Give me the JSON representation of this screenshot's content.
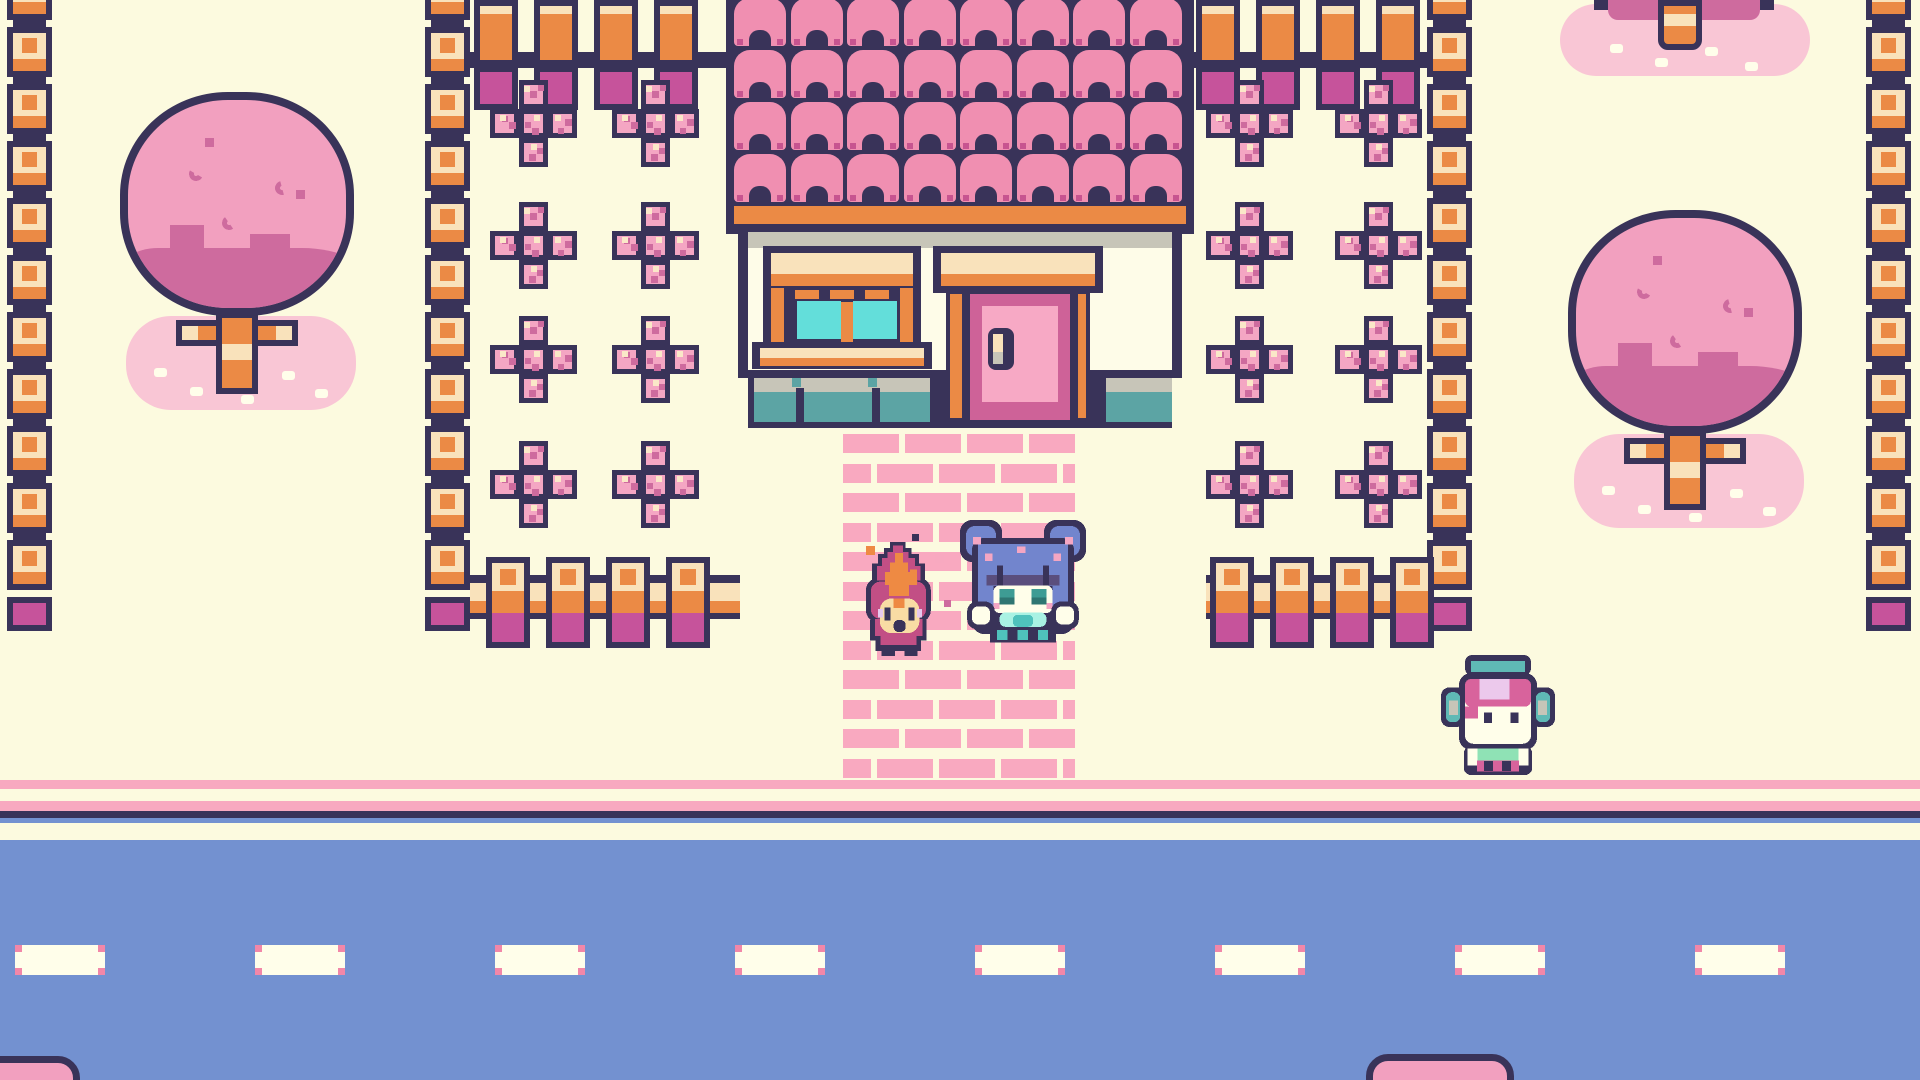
{
  "scene": {
    "width": 1920,
    "height": 1080,
    "label": "pastel-town-overworld"
  },
  "palette": {
    "cream": "#FCFADF",
    "navy": "#393359",
    "orange": "#EB8A45",
    "postCream": "#F9E2BB",
    "magenta": "#C6539B",
    "tilePink": "#F08FB1",
    "tileNotch": "#C75490",
    "flowerPink": "#F4A6C3",
    "flowerDark": "#CE6B9E",
    "flowerLight": "#FAE8C8",
    "treePink": "#F2A0BF",
    "treeDark": "#CE6B9E",
    "poolPink": "#F9C6D5",
    "white": "#FFFEEA",
    "gray": "#C7C5B8",
    "tealBase": "#5CA4A4",
    "glass": "#63DEDA",
    "doorPink": "#F7A9C5",
    "doorDark": "#CE6298",
    "roadBlue": "#7391D0",
    "stripePink": "#F8A9C0",
    "dashCorner": "#F287A8",
    "brickPink": "#F9A9C0",
    "wallFace": "#FEFCE8",
    "girlHair": "#7285CD",
    "girlBangs": "#5A4E7D",
    "girlEye": "#3E9C94",
    "girlEyeDark": "#2F7672",
    "mint": "#A9F2E3",
    "scarfTeal": "#4FC2BC",
    "flameRose": "#C24F85",
    "flameOrange": "#EE8A43",
    "flameFace": "#F8DCA4",
    "lavender": "#E6C8EE",
    "kidHair": "#D8639C",
    "kidLavender": "#ECC9EC",
    "kidTeal": "#5FB9B5",
    "kidMint": "#8FE2B5"
  },
  "layout": {
    "road": {
      "stripes": [
        [
          780,
          9
        ],
        [
          801,
          10
        ]
      ],
      "navy_line": [
        811,
        7
      ],
      "blue_sliver": [
        818,
        5
      ],
      "cream_strip": [
        823,
        17
      ],
      "asphalt": [
        840,
        240
      ],
      "dashes": {
        "y": 945,
        "h": 30,
        "start_x": 15,
        "width": 90,
        "period": 240,
        "count": 8,
        "corner": 7
      }
    },
    "path": {
      "x": 843,
      "y": 434,
      "w": 232,
      "rows": 12,
      "row_period": 29.5,
      "row_h": 19,
      "brick_w": 56,
      "brick_gap": 6,
      "odd_offset": 34,
      "odd_first_w": 28
    },
    "fence_columns": [
      {
        "x": 7,
        "y": -30,
        "units": 11,
        "cap": true,
        "name": "fence-column-left-edge"
      },
      {
        "x": 425,
        "y": -30,
        "units": 11,
        "cap": true,
        "name": "fence-column-left-garden"
      },
      {
        "x": 1427,
        "y": -30,
        "units": 11,
        "cap": true,
        "name": "fence-column-right-garden"
      },
      {
        "x": 1866,
        "y": -30,
        "units": 11,
        "cap": true,
        "name": "fence-column-right-edge"
      }
    ],
    "fence_unit": {
      "w": 45,
      "block_h": 50,
      "period": 57,
      "cap_h": 34
    },
    "top_fence_rows": [
      {
        "x": 470,
        "w": 258,
        "posts": [
          4,
          64,
          124,
          184
        ],
        "name": "top-fence-row-left"
      },
      {
        "x": 1192,
        "w": 235,
        "posts": [
          4,
          64,
          124,
          184
        ],
        "name": "top-fence-row-right"
      }
    ],
    "garden_fence_rows": [
      {
        "x": 470,
        "w": 270,
        "posts": [
          16,
          76,
          136,
          196
        ],
        "name": "garden-fence-left"
      },
      {
        "x": 1206,
        "w": 221,
        "posts": [
          4,
          64,
          124,
          184
        ],
        "name": "garden-fence-right"
      }
    ],
    "garden_fence_y": 557,
    "flowers": {
      "size": 87,
      "cell": 29,
      "rows": [
        80,
        202,
        316,
        441
      ],
      "cols_left": [
        490,
        612
      ],
      "cols_right": [
        1206,
        1335
      ]
    },
    "house": {
      "roof": [
        726,
        0,
        468,
        234
      ],
      "roof_trim": [
        734,
        206,
        452,
        18
      ],
      "tiles": {
        "x": 734,
        "y": -2,
        "cols": 8,
        "rows": 4,
        "tw": 52,
        "th": 48,
        "sx": 56.5,
        "sy": 52
      },
      "wall": [
        738,
        226,
        444,
        152
      ],
      "wall_shadow": [
        748,
        232,
        424,
        16
      ],
      "wall_face": [
        748,
        248,
        424,
        122
      ],
      "base": {
        "navy": [
          748,
          370,
          424,
          58
        ],
        "sections": [
          [
            754,
            378,
            176
          ],
          [
            1106,
            378,
            66
          ]
        ],
        "separators": [
          [
            796,
            388,
            8,
            34
          ],
          [
            872,
            388,
            8,
            34
          ]
        ],
        "notches": [
          [
            792,
            378,
            9,
            9
          ],
          [
            868,
            378,
            9,
            9
          ]
        ]
      },
      "window": {
        "frame": [
          763,
          246,
          158,
          104
        ],
        "awning_top": [
          771,
          253,
          142,
          21
        ],
        "awning_trim": [
          771,
          274,
          142,
          12
        ],
        "side_l": [
          771,
          288,
          13,
          56
        ],
        "side_r": [
          900,
          288,
          13,
          56
        ],
        "dashes": [
          [
            795,
            290,
            24,
            9
          ],
          [
            830,
            290,
            24,
            9
          ],
          [
            865,
            290,
            24,
            9
          ]
        ],
        "panes": [
          [
            797,
            301,
            44,
            38
          ],
          [
            853,
            301,
            44,
            38
          ]
        ],
        "divider": [
          841,
          302,
          12,
          40
        ],
        "sill": [
          752,
          342,
          180,
          27
        ],
        "sill_top": [
          760,
          348,
          164,
          10
        ],
        "sill_trim": [
          760,
          358,
          164,
          8
        ]
      },
      "door": {
        "awning": [
          933,
          246,
          170,
          47
        ],
        "awning_top": [
          941,
          253,
          154,
          21
        ],
        "awning_trim": [
          941,
          274,
          154,
          12
        ],
        "post_l_outline": [
          946,
          290,
          22,
          132
        ],
        "post_l": [
          950,
          294,
          14,
          124
        ],
        "post_r_outline": [
          1068,
          290,
          22,
          132
        ],
        "post_r": [
          1072,
          294,
          14,
          124
        ],
        "panel_outline": [
          962,
          286,
          116,
          142
        ],
        "panel_frame": [
          970,
          294,
          100,
          126
        ],
        "panel": [
          982,
          306,
          76,
          96
        ],
        "handle_outline": [
          988,
          328,
          26,
          42
        ],
        "handle_top": [
          993,
          334,
          10,
          20
        ],
        "handle_base": [
          993,
          352,
          10,
          12
        ]
      }
    },
    "trees": [
      {
        "name": "blossom-tree-left",
        "canopy": [
          120,
          92,
          234,
          224
        ],
        "pool": [
          126,
          316,
          230,
          94
        ],
        "trunk": [
          216,
          312,
          42,
          82
        ],
        "branch": [
          176,
          320,
          122,
          26
        ]
      },
      {
        "name": "blossom-tree-right",
        "canopy": [
          1568,
          210,
          234,
          224
        ],
        "pool": [
          1574,
          434,
          230,
          94
        ],
        "trunk": [
          1664,
          430,
          42,
          80
        ],
        "branch": [
          1624,
          438,
          122,
          26
        ]
      }
    ],
    "partial_trees": {
      "top_right": {
        "pool": [
          1560,
          4,
          250,
          72
        ],
        "trunk": [
          1658,
          0,
          44,
          50
        ],
        "band": [
          1608,
          0,
          152,
          20
        ]
      },
      "bottom_tops": [
        {
          "name": "treetop-bottom-left",
          "x": -46,
          "y": 1056,
          "w": 126,
          "h": 60
        },
        {
          "name": "treetop-bottom-right",
          "x": 1366,
          "y": 1054,
          "w": 148,
          "h": 60
        }
      ]
    },
    "sparkles": [
      {
        "x": 866,
        "y": 546,
        "s": 9,
        "c": "flameOrange"
      },
      {
        "x": 935,
        "y": 554,
        "s": 9,
        "c": "stripePink"
      },
      {
        "x": 944,
        "y": 600,
        "s": 7,
        "c": "flowerDark"
      },
      {
        "x": 912,
        "y": 534,
        "s": 7,
        "c": "navy"
      }
    ],
    "characters": {
      "flame_spirit": {
        "x": 854,
        "y": 542,
        "unit": 6,
        "gw": 14,
        "gh": 19
      },
      "girl": {
        "x": 960,
        "y": 514,
        "unit": 6,
        "gw": 21,
        "gh": 23
      },
      "headphones_kid": {
        "x": 1441,
        "y": 655,
        "unit": 6,
        "gw": 19,
        "gh": 20
      }
    }
  }
}
